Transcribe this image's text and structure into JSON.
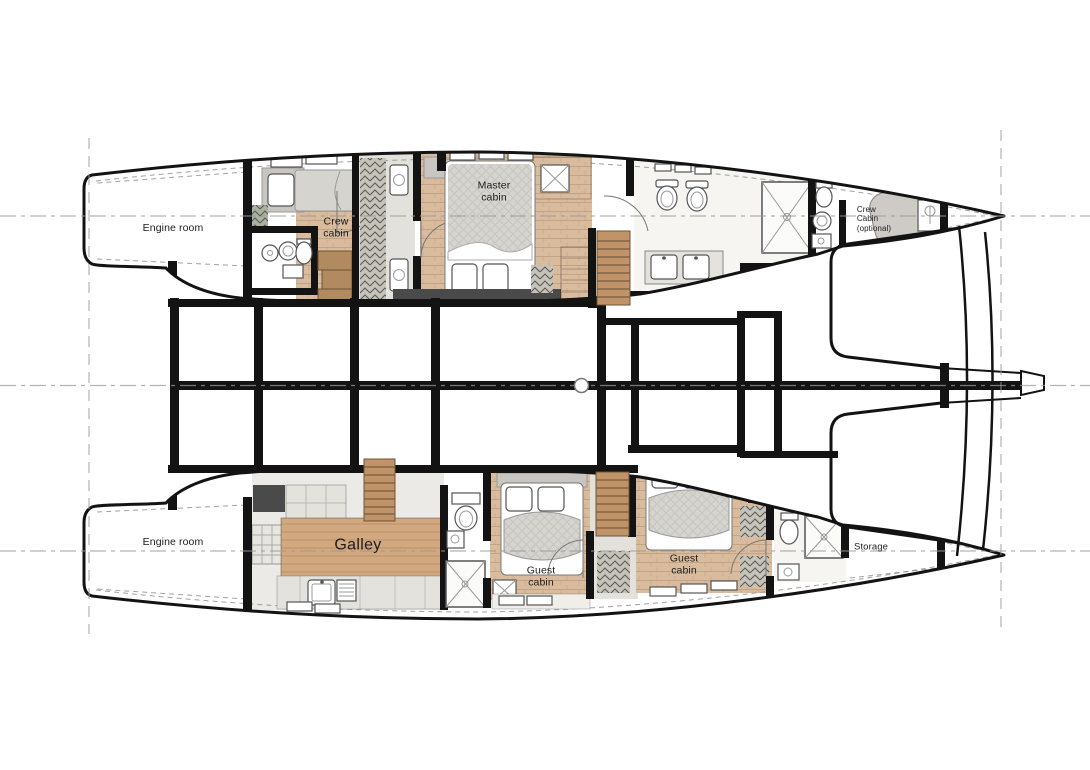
{
  "diagram": {
    "kind": "catamaran-yacht-deck-plan",
    "labels": {
      "engine_room_port": "Engine room",
      "engine_room_starboard": "Engine room",
      "crew_cabin": "Crew\ncabin",
      "master_cabin": "Master\ncabin",
      "crew_cabin_optional": "Crew\nCabin\n(optional)",
      "galley": "Galley",
      "guest_cabin_fwd": "Guest\ncabin",
      "guest_cabin_mid": "Guest\ncabin",
      "storage": "Storage"
    },
    "colors": {
      "wall": "#131313",
      "wood": "#d9bb9e",
      "island": "#d2a87e",
      "stairwood": "#c09468",
      "grayfloor": "#e3e1dc",
      "grayfloor2": "#eceae6",
      "counter": "#e4e2dd",
      "darkunit": "#4a4a4a",
      "mattress": "#d6d4ce",
      "headboard": "#c9c6c1",
      "locker": "#c6c3ba",
      "lockergreen": "#a9b1a1",
      "refline": "#9a9a9a",
      "label": "#1d1d1d"
    }
  }
}
